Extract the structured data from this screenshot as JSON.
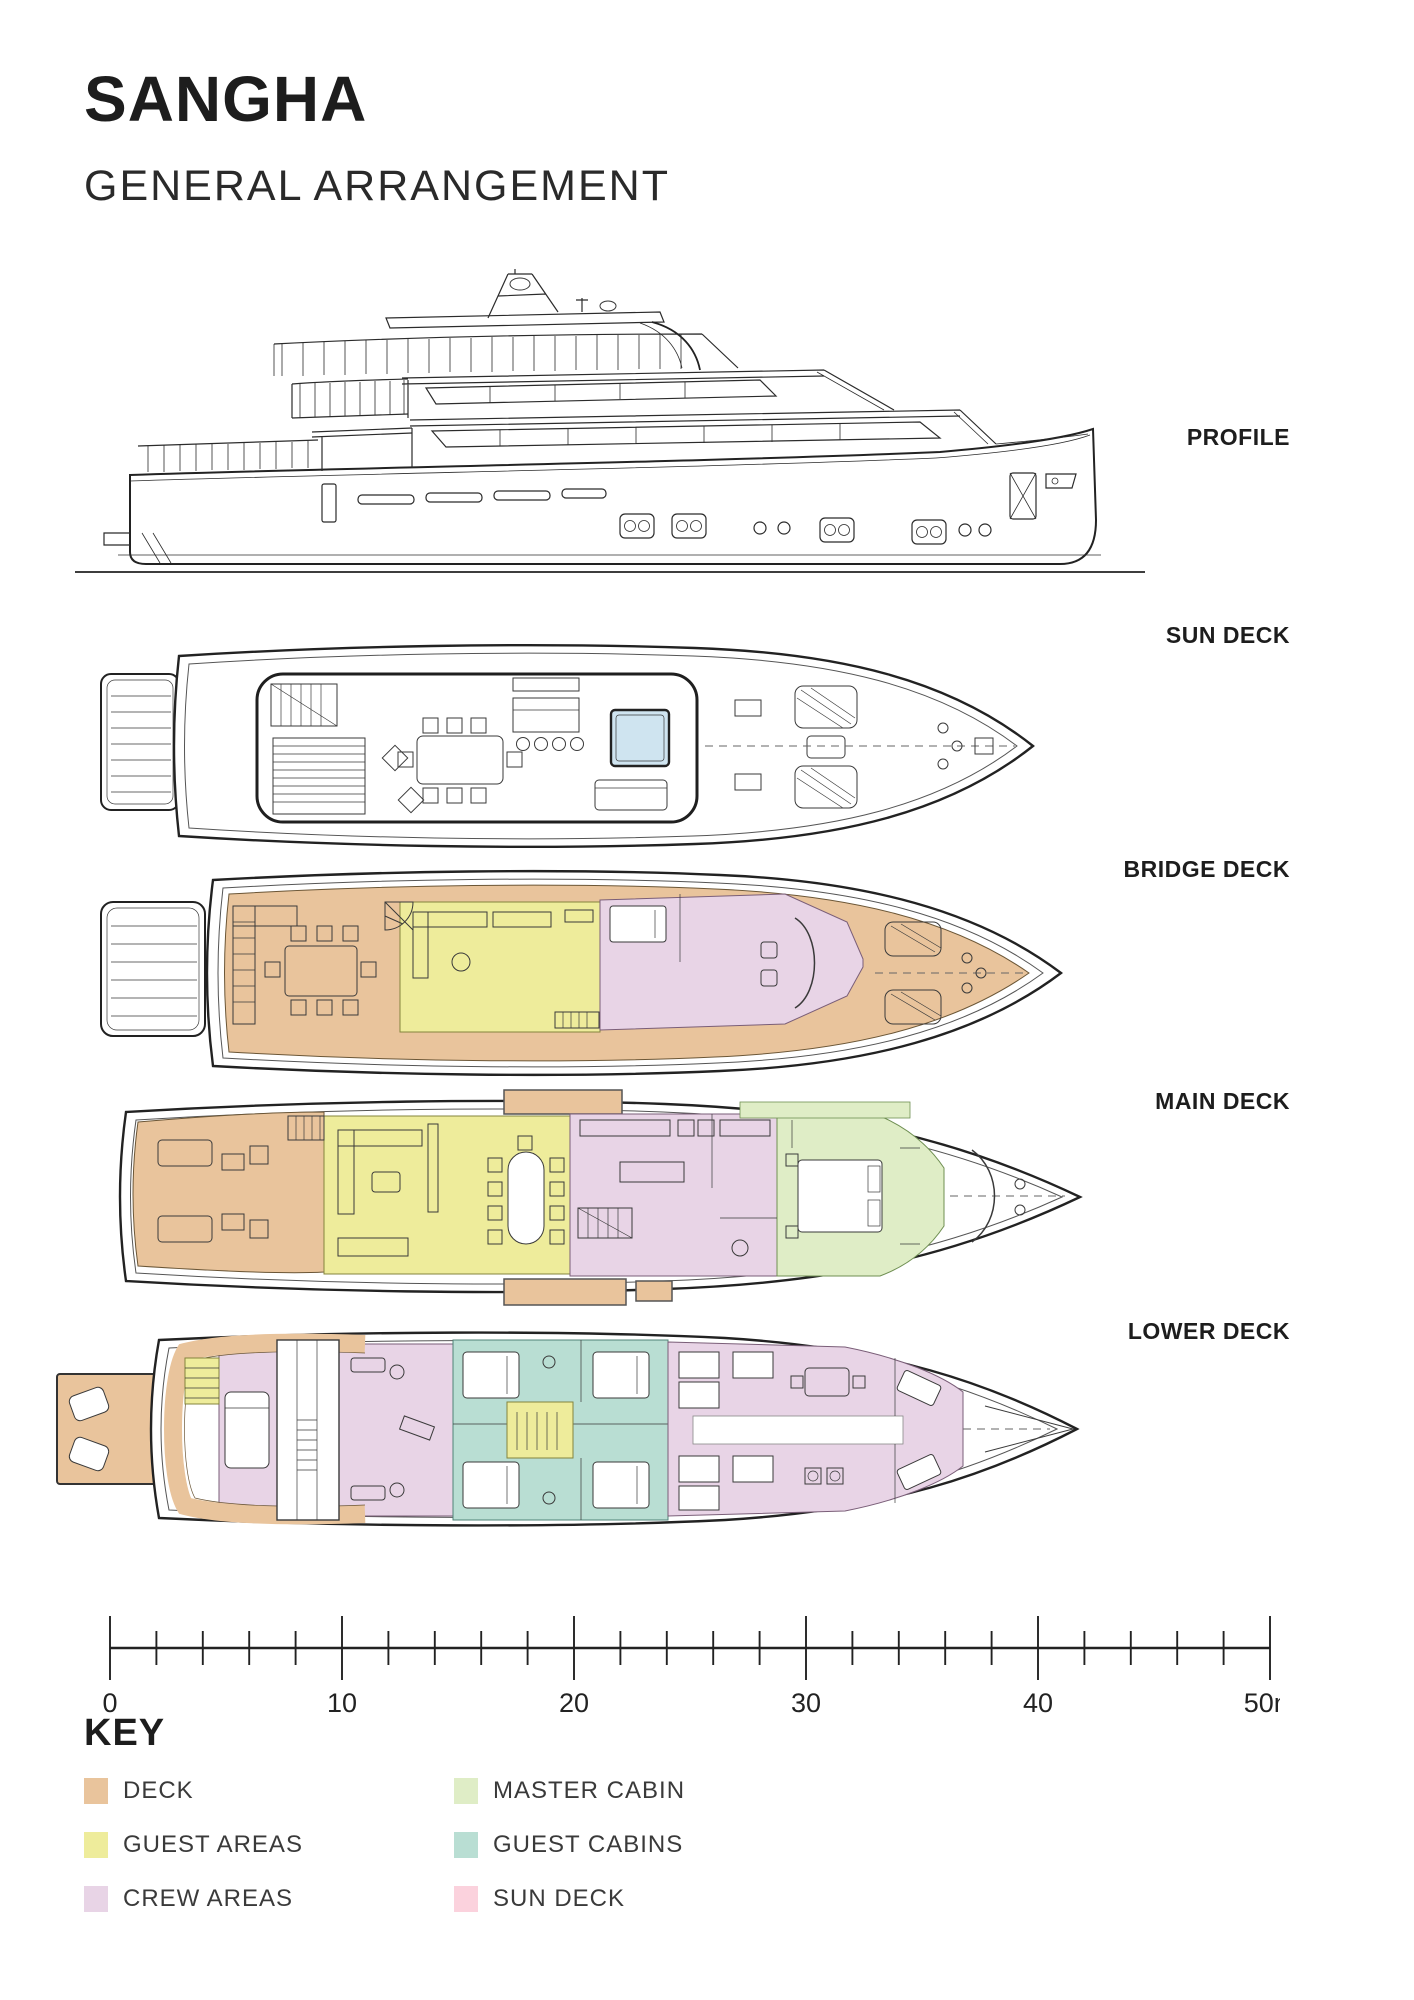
{
  "header": {
    "title": "SANGHA",
    "subtitle": "GENERAL ARRANGEMENT"
  },
  "views": {
    "profile": {
      "label": "PROFILE"
    },
    "sun_deck": {
      "label": "SUN DECK"
    },
    "bridge_deck": {
      "label": "BRIDGE DECK"
    },
    "main_deck": {
      "label": "MAIN DECK"
    },
    "lower_deck": {
      "label": "LOWER DECK"
    }
  },
  "scale_bar": {
    "tick_labels": [
      "0",
      "10",
      "20",
      "30",
      "40",
      "50m"
    ]
  },
  "key": {
    "title": "KEY",
    "items": [
      {
        "label": "DECK",
        "color": "#e9c49c"
      },
      {
        "label": "GUEST AREAS",
        "color": "#eeec9b"
      },
      {
        "label": "CREW AREAS",
        "color": "#e8d4e6"
      },
      {
        "label": "MASTER CABIN",
        "color": "#dfedc6"
      },
      {
        "label": "GUEST CABINS",
        "color": "#b9ded3"
      },
      {
        "label": "SUN DECK",
        "color": "#fbd2dd"
      }
    ]
  },
  "colors": {
    "deck": "#e9c49c",
    "guest_areas": "#eeec9b",
    "crew_areas": "#e8d4e6",
    "master_cabin": "#dfedc6",
    "guest_cabins": "#b9ded3",
    "sun_deck_pink": "#fbd2dd",
    "pool": "#cfe4f0",
    "line": "#2b2b2b"
  }
}
